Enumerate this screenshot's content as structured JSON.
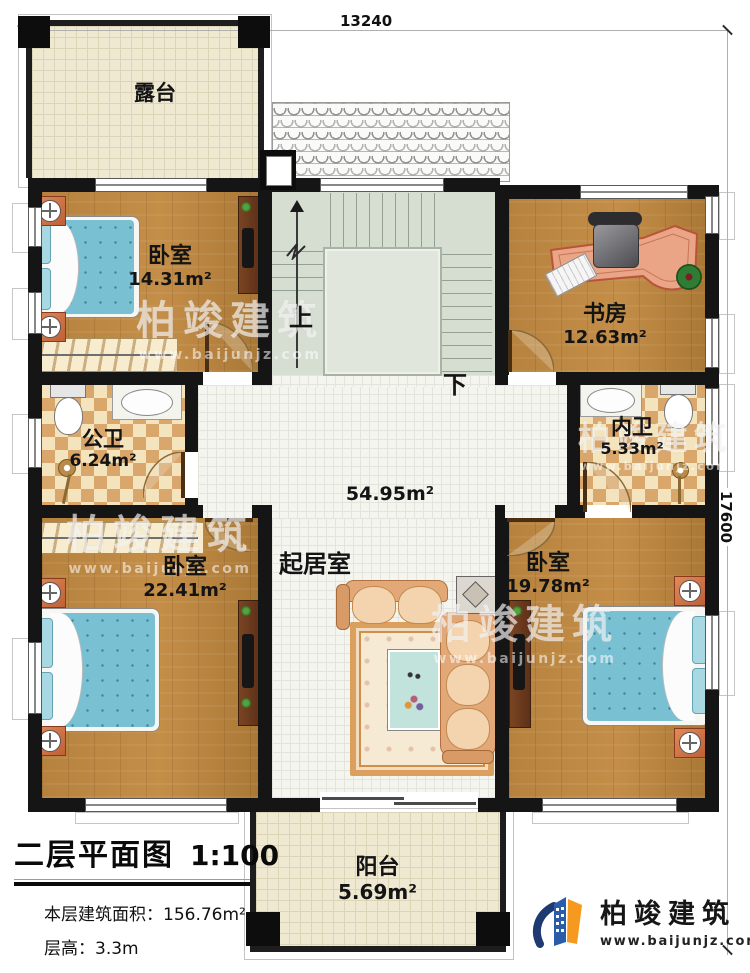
{
  "plan": {
    "dim_width": "13240",
    "dim_height": "17600"
  },
  "rooms": {
    "terrace": {
      "name": "露台"
    },
    "bedroom_tl": {
      "name": "卧室",
      "area": "14.31m²"
    },
    "study": {
      "name": "书房",
      "area": "12.63m²"
    },
    "public_bath": {
      "name": "公卫",
      "area": "6.24m²"
    },
    "private_bath": {
      "name": "内卫",
      "area": "5.33m²"
    },
    "living": {
      "name": "起居室",
      "area": "54.95m²"
    },
    "bedroom_bl": {
      "name": "卧室",
      "area": "22.41m²"
    },
    "bedroom_br": {
      "name": "卧室",
      "area": "19.78m²"
    },
    "balcony": {
      "name": "阳台",
      "area": "5.69m²"
    }
  },
  "stairs": {
    "up": "上",
    "down": "下"
  },
  "title_block": {
    "title": "二层平面图",
    "scale": "1:100",
    "floor_area_label": "本层建筑面积：",
    "floor_area_value": "156.76m²",
    "floor_height_label": "层高：",
    "floor_height_value": "3.3m"
  },
  "branding": {
    "company": "柏竣建筑",
    "website": "www.baijunjz.com"
  },
  "watermark": {
    "text": "柏竣建筑",
    "website": "www.baijunjz.com"
  },
  "colors": {
    "wall": "#151515",
    "wood": "#b6823e",
    "tile_dark": "#d9a66b",
    "tile_light": "#f4e4bd",
    "bed": "#7ac0d3",
    "logo_blue": "#2a5caa",
    "logo_orange": "#f59a1e"
  }
}
